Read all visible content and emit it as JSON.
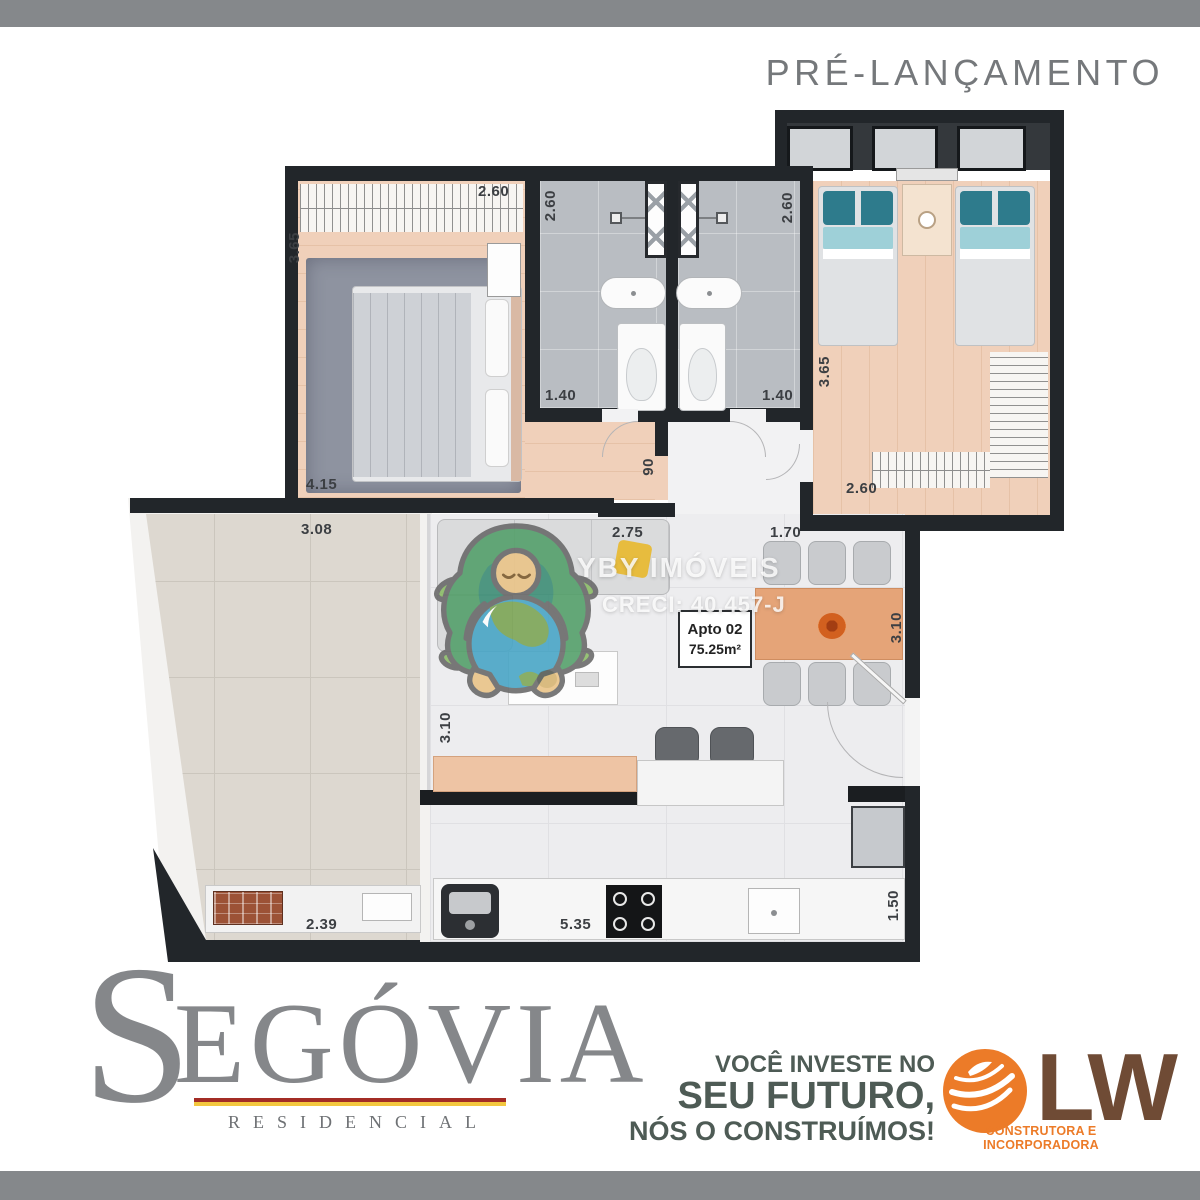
{
  "page": {
    "pre_launch": "PRÉ-LANÇAMENTO"
  },
  "plan": {
    "unit": {
      "name": "Apto 02",
      "area": "75.25m²"
    },
    "dimensions": {
      "master_top": "2.60",
      "master_left": "3.65",
      "master_bottom": "4.15",
      "master_door": "90",
      "bath_left_height": "2.60",
      "bath_left_width": "1.40",
      "bath_right_height": "2.60",
      "bath_right_width": "1.40",
      "bedroom2_left": "3.65",
      "bedroom2_bottom": "2.60",
      "living_top": "2.75",
      "hall_bottom": "1.70",
      "dining_right": "3.10",
      "living_left": "3.10",
      "terrace_top": "3.08",
      "terrace_bottom": "2.39",
      "kitchen_bottom": "5.35",
      "kitchen_right": "1.50"
    }
  },
  "watermark": {
    "name": "YBY IMÓVEIS",
    "creci": "CRECI: 40.457-J"
  },
  "branding": {
    "project": {
      "initial": "S",
      "rest": "EGÓVIA",
      "subtitle": "RESIDENCIAL"
    },
    "slogan": {
      "line1": "VOCÊ INVESTE NO",
      "line2": "SEU FUTURO,",
      "line3": "NÓS O CONSTRUÍMOS!"
    },
    "builder": {
      "name": "LW",
      "subtitle": "CONSTRUTORA E INCORPORADORA"
    }
  },
  "colors": {
    "wall": "#22262a",
    "floor_warm": "#f0d0ba",
    "floor_bath": "#b9bdc2",
    "floor_living": "#ededef",
    "floor_terrace": "#ddd8d0",
    "floor_hall": "#f2f2f3",
    "table_wood": "#e5a478",
    "pillow_teal": "#2e7b8c",
    "pillow_yellow": "#e7bc3e",
    "bar_gray": "#85888b",
    "brand_gray": "#85878a",
    "brand_red": "#a32c25",
    "brand_gold": "#f3c73f",
    "slogan_green": "#4e5b55",
    "lw_orange": "#ec7b28",
    "lw_brown": "#6f4b35",
    "dim_text": "#3c3f43",
    "prelaunch": "#75787b"
  }
}
